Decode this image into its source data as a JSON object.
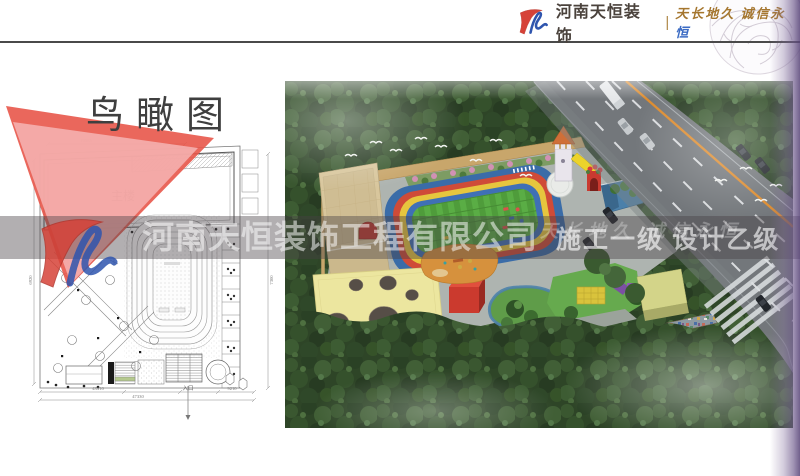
{
  "header": {
    "brand": "河南天恒装饰",
    "separator": "|",
    "tagline_main": "天长地久 诚信永",
    "tagline_last": "恒"
  },
  "page": {
    "title": "鸟瞰图"
  },
  "watermark": {
    "company": "河南天恒装饰工程有限公司",
    "grades": "施工一级 设计乙级",
    "slogan": "天长地久 诚信永恒"
  },
  "plan": {
    "labels": {
      "main_building": "主楼",
      "entrance": "入口"
    },
    "dimensions": {
      "top": "19585",
      "left": "6920",
      "right": "7300",
      "bottom_left": "43310",
      "bottom_total": "47330",
      "bottom_right": "9210"
    }
  }
}
